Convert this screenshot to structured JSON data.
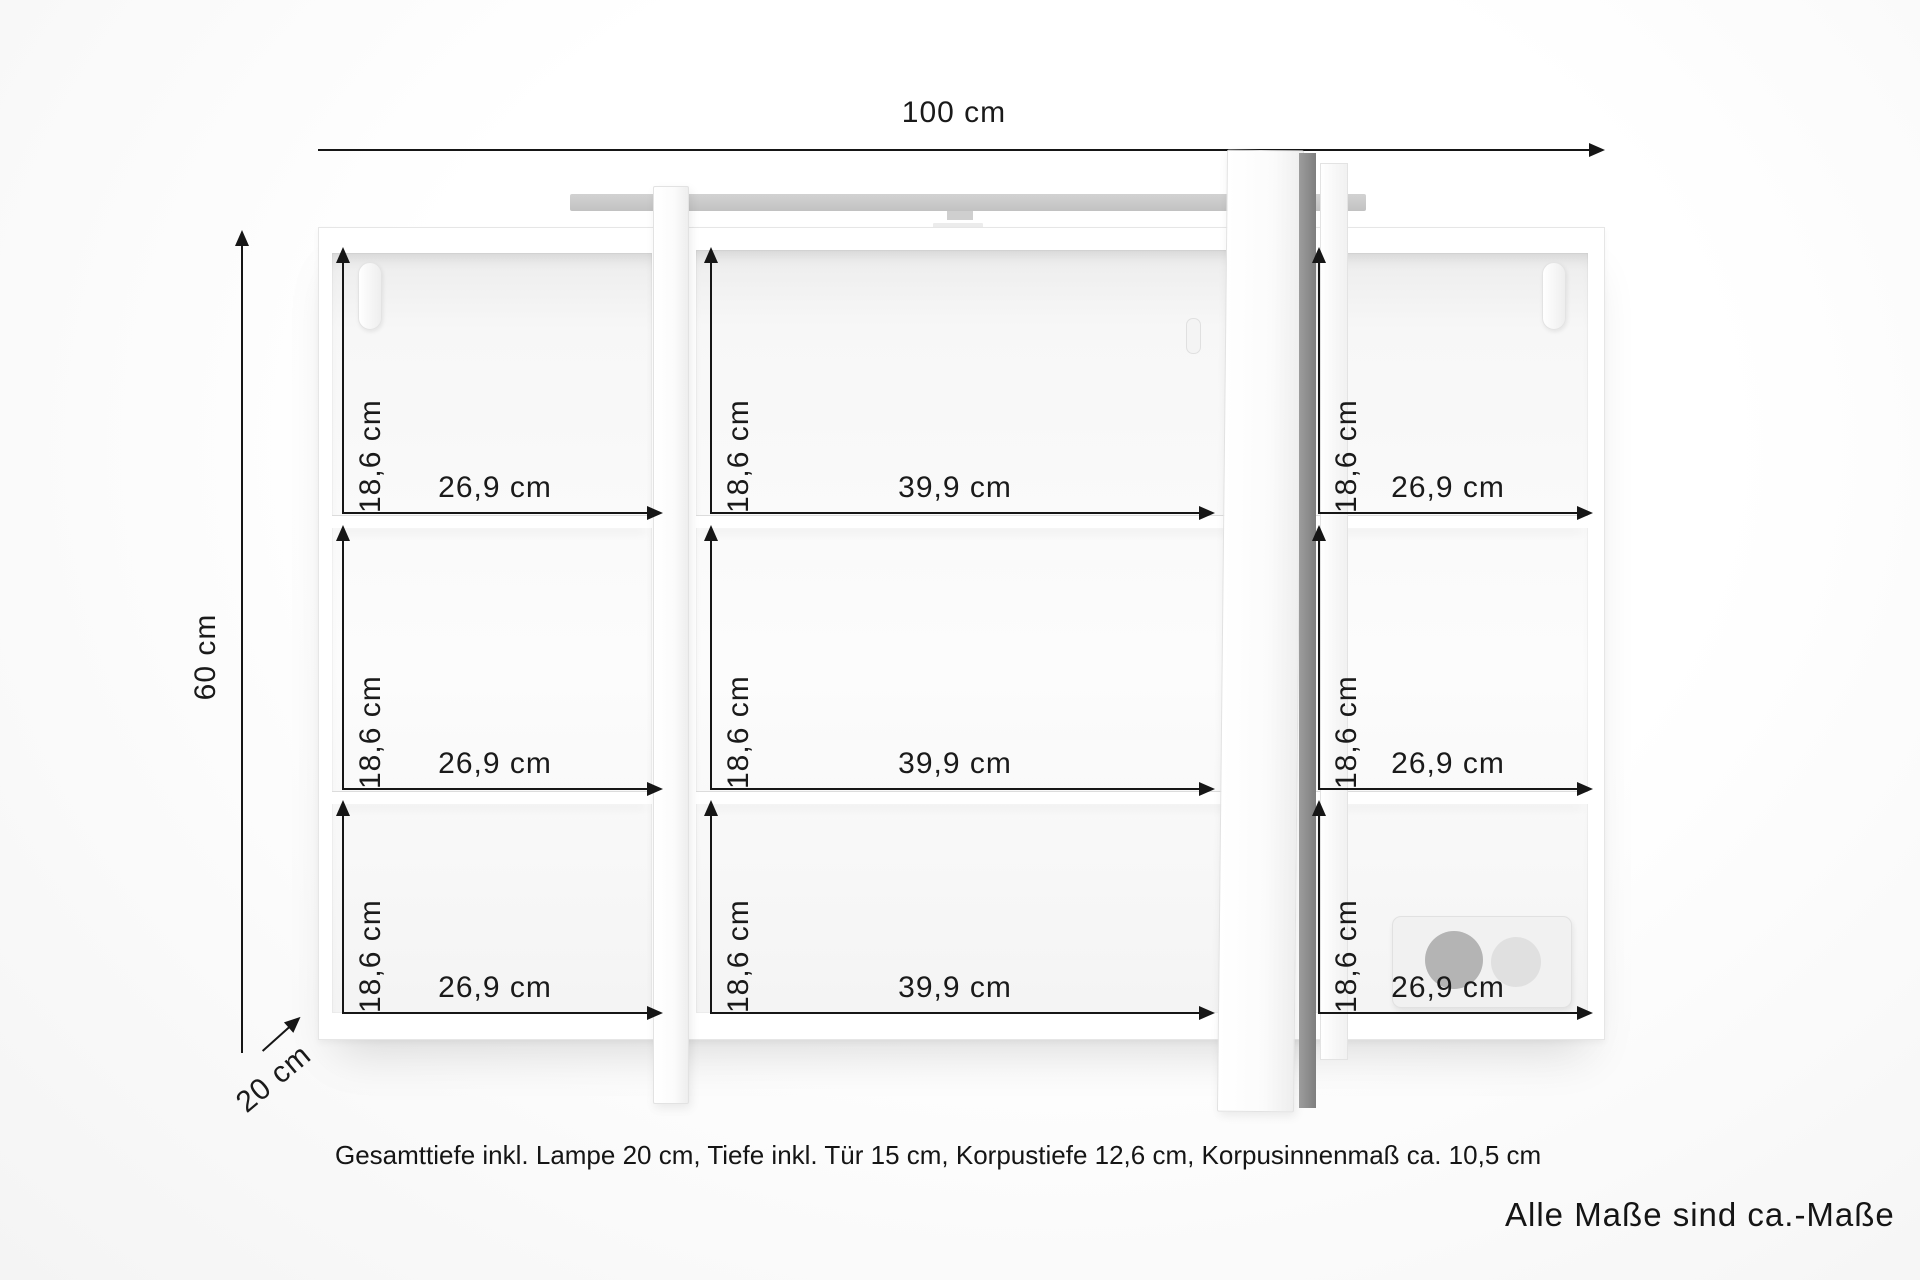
{
  "overall_dimensions": {
    "width": "100 cm",
    "height": "60 cm",
    "depth": "20 cm"
  },
  "cells": [
    {
      "h": "18,6 cm",
      "w": "26,9 cm"
    },
    {
      "h": "18,6 cm",
      "w": "39,9 cm"
    },
    {
      "h": "18,6 cm",
      "w": "26,9 cm"
    },
    {
      "h": "18,6 cm",
      "w": "26,9 cm"
    },
    {
      "h": "18,6 cm",
      "w": "39,9 cm"
    },
    {
      "h": "18,6 cm",
      "w": "26,9 cm"
    },
    {
      "h": "18,6 cm",
      "w": "26,9 cm"
    },
    {
      "h": "18,6 cm",
      "w": "39,9 cm"
    },
    {
      "h": "18,6 cm",
      "w": "26,9 cm"
    }
  ],
  "footnote": "Gesamttiefe inkl. Lampe 20 cm, Tiefe inkl. Tür 15 cm, Korpustiefe 12,6 cm, Korpusinnenmaß ca. 10,5 cm",
  "disclaimer": "Alle Maße sind ca.-Maße",
  "colors": {
    "dimension_lines": "#161616",
    "lamp_bar": "#c9c9c9",
    "door_edge": "#8c8c8c",
    "socket_dark": "#b4b4b4",
    "socket_light": "#e0e0e0"
  }
}
